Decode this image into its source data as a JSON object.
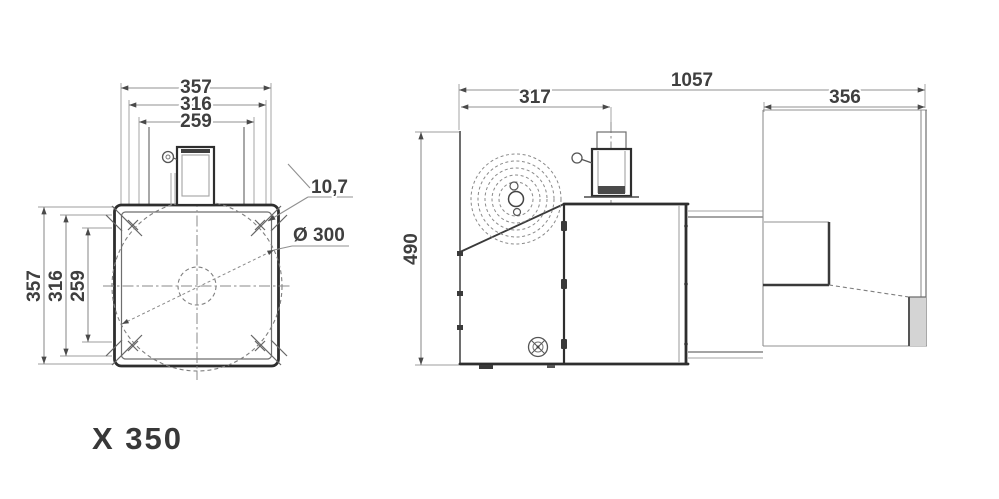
{
  "page": {
    "background": "#ffffff",
    "model_label": "X 350"
  },
  "front_view": {
    "name": "front-view",
    "dim_top_outer": "357",
    "dim_top_mid": "316",
    "dim_top_inner": "259",
    "dim_side_outer": "357",
    "dim_side_mid": "316",
    "dim_side_inner": "259",
    "callout_hole_diameter": "10,7",
    "callout_circle_diameter": "Ø 300"
  },
  "side_view": {
    "name": "side-view",
    "dim_overall_length": "1057",
    "dim_left_section": "317",
    "dim_right_section": "356",
    "dim_overall_height": "490"
  },
  "colors": {
    "object_line": "#2e2e2e",
    "dimension_line": "#909090",
    "centerline": "#8a8a8a",
    "text": "#3f3f3f",
    "background": "#ffffff"
  }
}
